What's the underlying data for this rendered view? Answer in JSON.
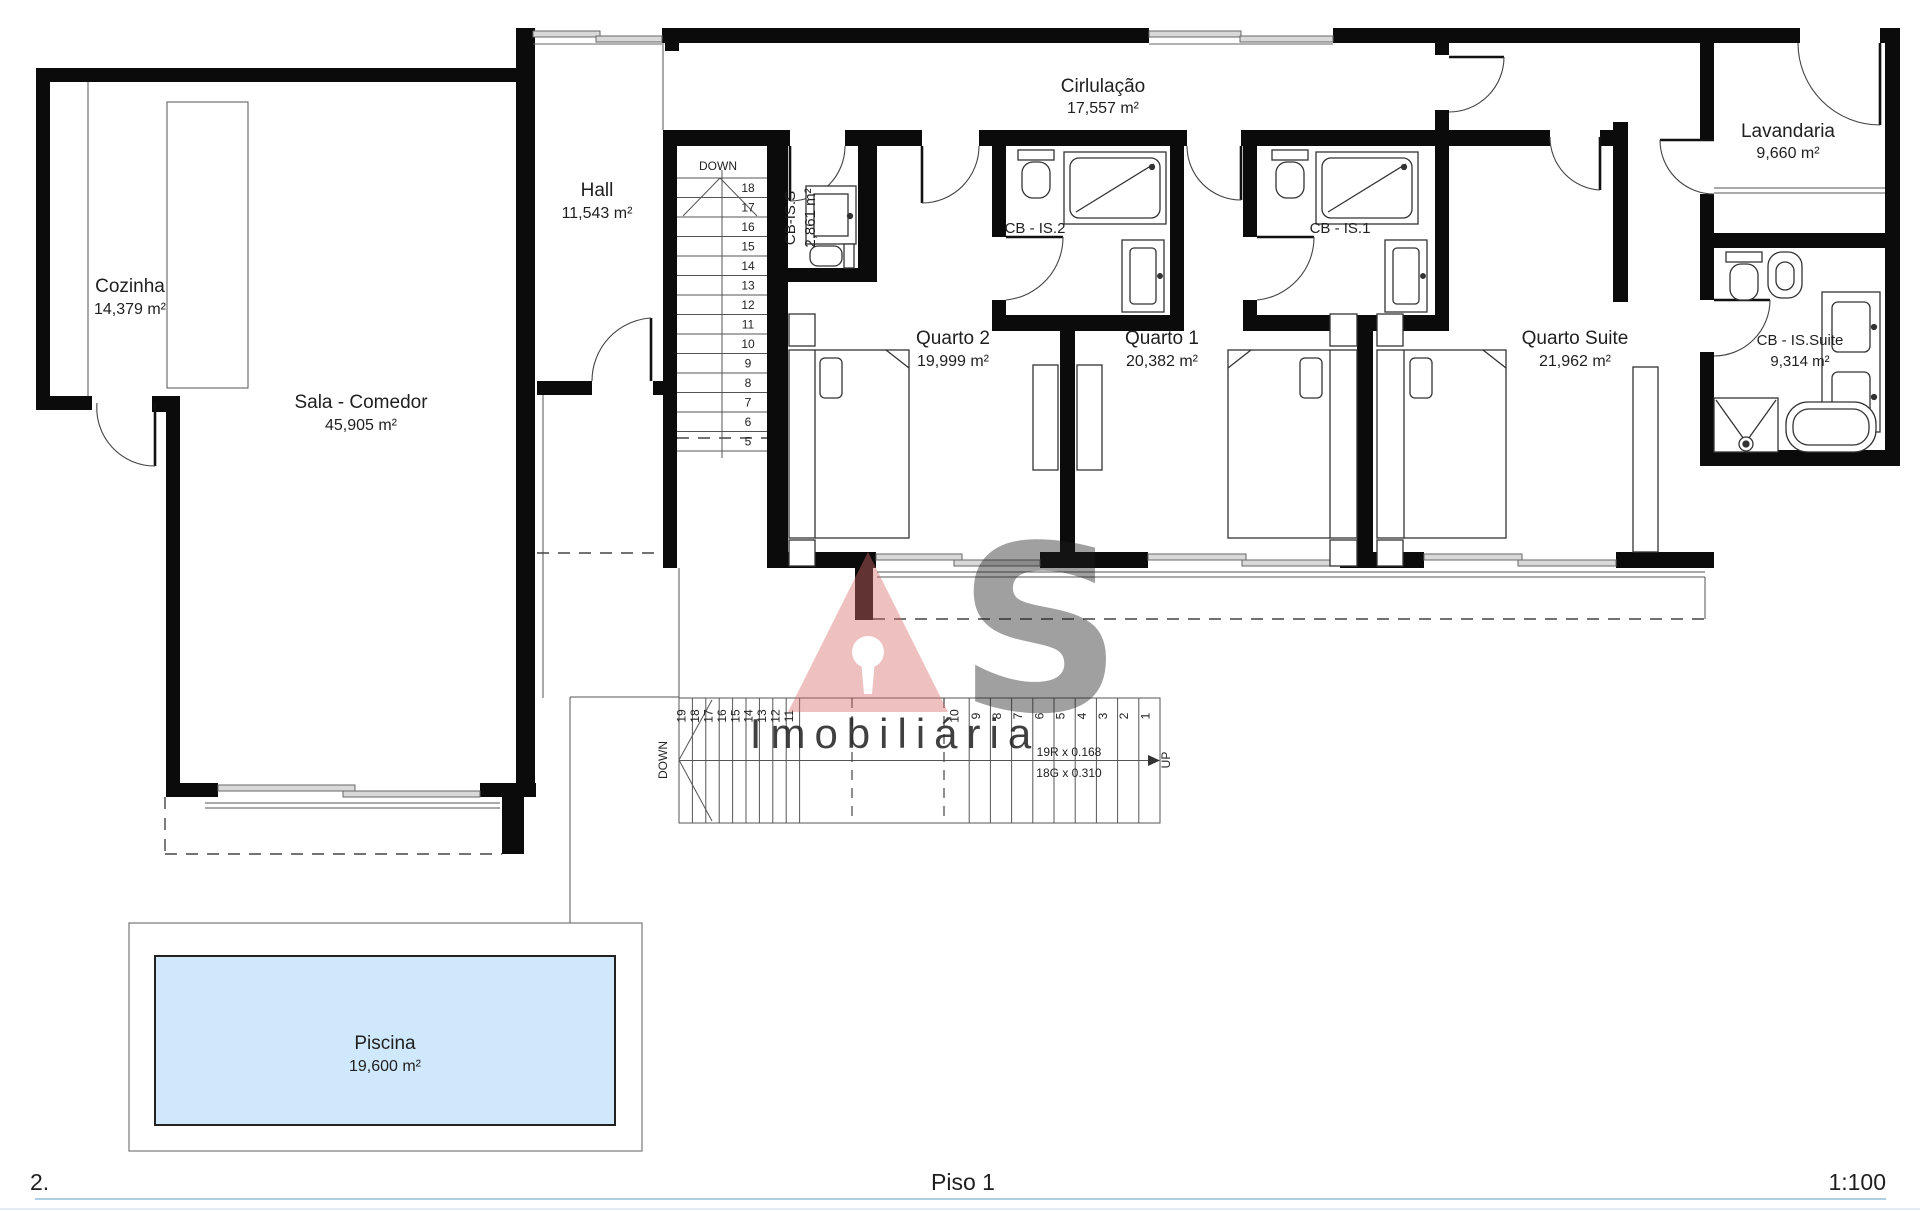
{
  "sheet": {
    "number": "2.",
    "title": "Piso 1",
    "scale": "1:100"
  },
  "watermark": {
    "company": "Imobiliária",
    "logo_s": "S"
  },
  "rooms": {
    "cozinha": {
      "name": "Cozinha",
      "area": "14,379 m²"
    },
    "sala": {
      "name": "Sala - Comedor",
      "area": "45,905 m²"
    },
    "hall": {
      "name": "Hall",
      "area": "11,543 m²"
    },
    "circulacao": {
      "name": "Cirlulação",
      "area": "17,557 m²"
    },
    "cb_is_s": {
      "name": "CB-IS.S",
      "area": "2,861 m²"
    },
    "cb_is_2": {
      "name": "CB - IS.2"
    },
    "cb_is_1": {
      "name": "CB - IS.1"
    },
    "quarto2": {
      "name": "Quarto 2",
      "area": "19,999 m²"
    },
    "quarto1": {
      "name": "Quarto 1",
      "area": "20,382 m²"
    },
    "quarto_suite": {
      "name": "Quarto Suite",
      "area": "21,962 m²"
    },
    "lavandaria": {
      "name": "Lavandaria",
      "area": "9,660 m²"
    },
    "cb_is_suite": {
      "name": "CB - IS.Suite",
      "area": "9,314 m²"
    },
    "piscina": {
      "name": "Piscina",
      "area": "19,600 m²"
    }
  },
  "stairs_upper": {
    "label": "DOWN",
    "numbers": [
      "18",
      "17",
      "16",
      "15",
      "14",
      "13",
      "12",
      "11",
      "10",
      "9",
      "8",
      "7",
      "6",
      "5"
    ]
  },
  "stairs_lower": {
    "label_down": "DOWN",
    "label_up": "UP",
    "numbers_left": [
      "19",
      "18",
      "17",
      "16",
      "15",
      "14",
      "13",
      "12",
      "11"
    ],
    "numbers_right": [
      "10",
      "9",
      "8",
      "7",
      "6",
      "5",
      "4",
      "3",
      "2",
      "1"
    ],
    "risers": "19R x 0.168",
    "goings": "18G x 0.310"
  },
  "colors": {
    "wall": "#0b0b0b",
    "pool": "#cfe8fb",
    "footer_text": "#8ab4d4",
    "watermark_red": "#d96a6a"
  }
}
